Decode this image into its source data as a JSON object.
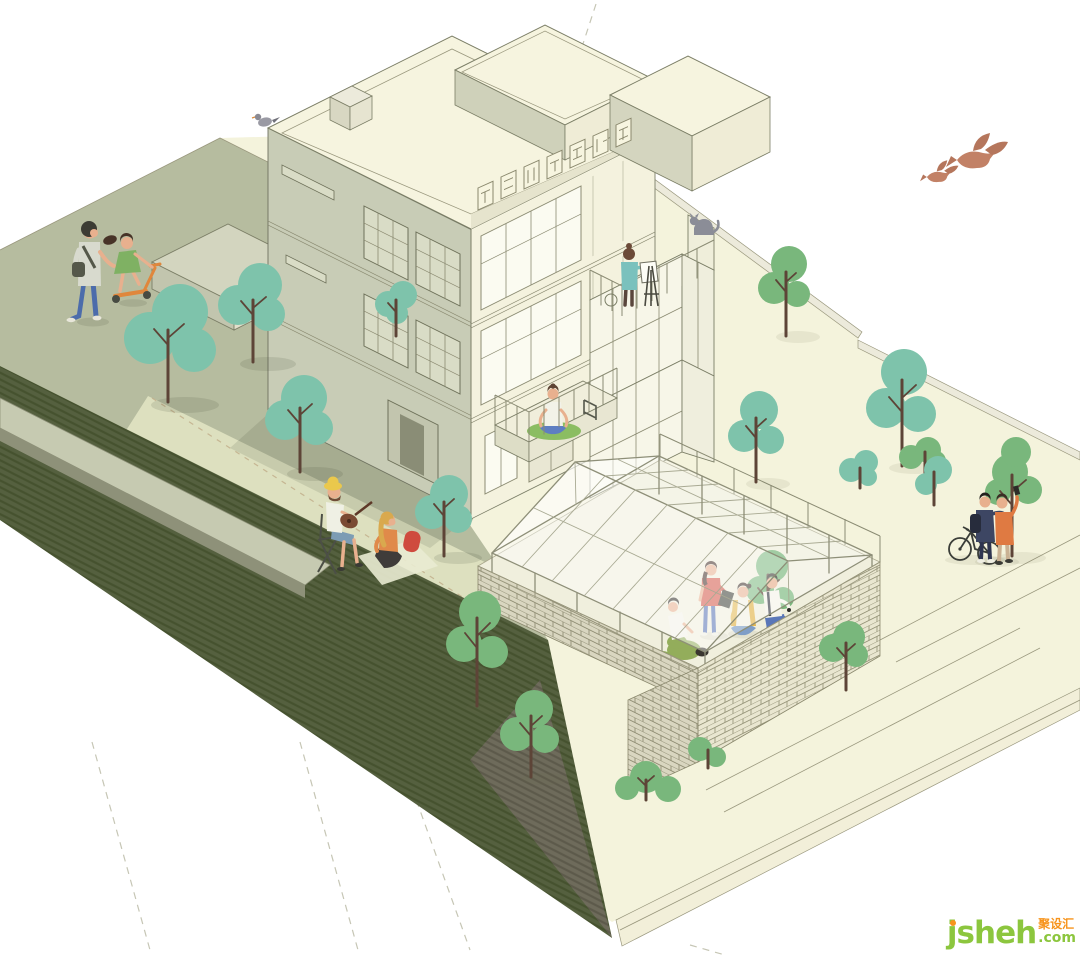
{
  "scene": {
    "title": "Axonometric illustration of a three-storey house with a timber-framed glasshouse courtyard on a landscaped plinth",
    "background": "#ffffff"
  },
  "watermark": {
    "brand": "jsheh",
    "tld": ".com",
    "cjk": "聚设汇",
    "brand_color": "#8cc63e",
    "accent_color": "#f7941d"
  },
  "palette": {
    "lawn": "#b6bc9f",
    "lawn_light": "#dde0bf",
    "ground_cream": "#f4f3dc",
    "plinth_dark": "#55603f",
    "plinth_gray": "#6e6b5b",
    "facade_left": "#c8ccb6",
    "facade_front": "#f4f2de",
    "roof": "#f6f4df",
    "brick_light": "#e9e6d0",
    "brick_shade": "#d9d6c0",
    "tree_teal": "#7ec3ab",
    "tree_green": "#79b77c",
    "trunk": "#5d4437",
    "bird": "#c28166",
    "skin": "#e8b08e"
  },
  "figures": [
    "pedestrian-adult",
    "child-on-scooter",
    "guitar-player",
    "picnic-listener",
    "rooftop-painter",
    "cat",
    "yoga-person",
    "standing-woman-with-laptop",
    "sitting-woman",
    "person-on-beanbag",
    "crouching-man",
    "selfie-couple",
    "bicycle",
    "pigeon",
    "flying-birds"
  ],
  "landscape": {
    "tree_count": 18,
    "greenhouse": "wireframe gable glasshouse over brick-walled courtyard",
    "signage": "rooftop-wireframe-sign (illegible 3D characters)"
  }
}
